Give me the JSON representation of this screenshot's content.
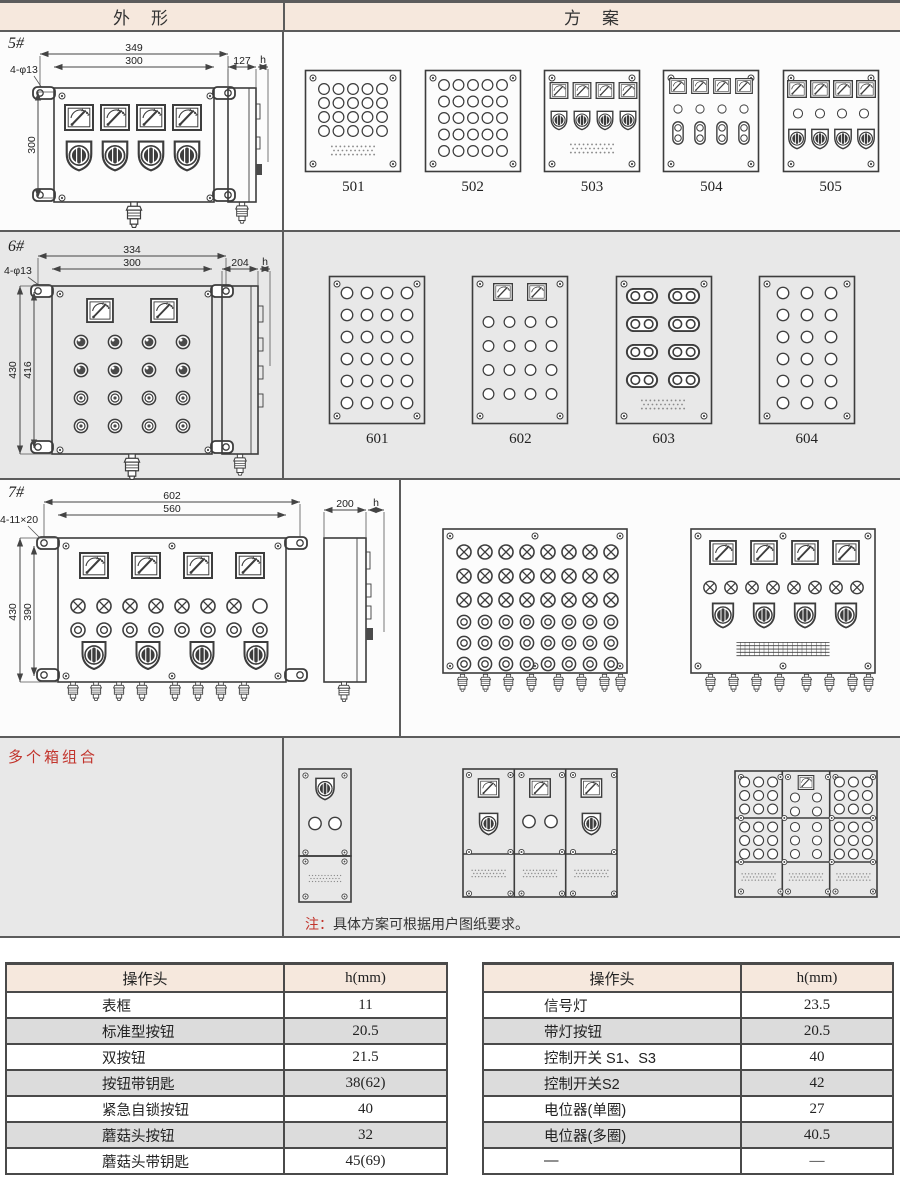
{
  "header": {
    "outline": "外　形",
    "scheme": "方　案"
  },
  "sections": {
    "s5": {
      "label": "5#",
      "schemes": [
        "501",
        "502",
        "503",
        "504",
        "505"
      ],
      "dims": {
        "outer_width": "349",
        "inner_width": "300",
        "holes": "4-φ13",
        "height": "300",
        "depth": "127",
        "h_label": "h"
      }
    },
    "s6": {
      "label": "6#",
      "schemes": [
        "601",
        "602",
        "603",
        "604"
      ],
      "dims": {
        "outer_width": "334",
        "inner_width": "300",
        "holes": "4-φ13",
        "outer_height": "430",
        "inner_height": "416",
        "depth": "204",
        "h_label": "h"
      }
    },
    "s7": {
      "label": "7#",
      "dims": {
        "outer_width": "602",
        "inner_width": "560",
        "holes": "4-11×20",
        "outer_height": "430",
        "inner_height": "390",
        "depth": "200",
        "h_label": "h"
      }
    },
    "combo": {
      "label": "多个箱组合"
    }
  },
  "note": {
    "prefix": "注：",
    "text": "具体方案可根据用户图纸要求。"
  },
  "tables": {
    "left": {
      "headers": [
        "操作头",
        "h(mm)"
      ],
      "rows": [
        [
          "表框",
          "11"
        ],
        [
          "标准型按钮",
          "20.5"
        ],
        [
          "双按钮",
          "21.5"
        ],
        [
          "按钮带钥匙",
          "38(62)"
        ],
        [
          "紧急自锁按钮",
          "40"
        ],
        [
          "蘑菇头按钮",
          "32"
        ],
        [
          "蘑菇头带钥匙",
          "45(69)"
        ]
      ]
    },
    "right": {
      "headers": [
        "操作头",
        "h(mm)"
      ],
      "rows": [
        [
          "信号灯",
          "23.5"
        ],
        [
          "带灯按钮",
          "20.5"
        ],
        [
          "控制开关 S1、S3",
          "40"
        ],
        [
          "控制开关S2",
          "42"
        ],
        [
          "电位器(单圈)",
          "27"
        ],
        [
          "电位器(多圈)",
          "40.5"
        ],
        [
          "—",
          "—"
        ]
      ]
    }
  },
  "colors": {
    "header_bg": "#f6e8dd",
    "grid_line": "#5c5c5c",
    "row_alt": "#dcdcdc",
    "accent_red": "#c2342c",
    "section_gray": "#e8e8e8",
    "ink": "#3d3d3d"
  }
}
